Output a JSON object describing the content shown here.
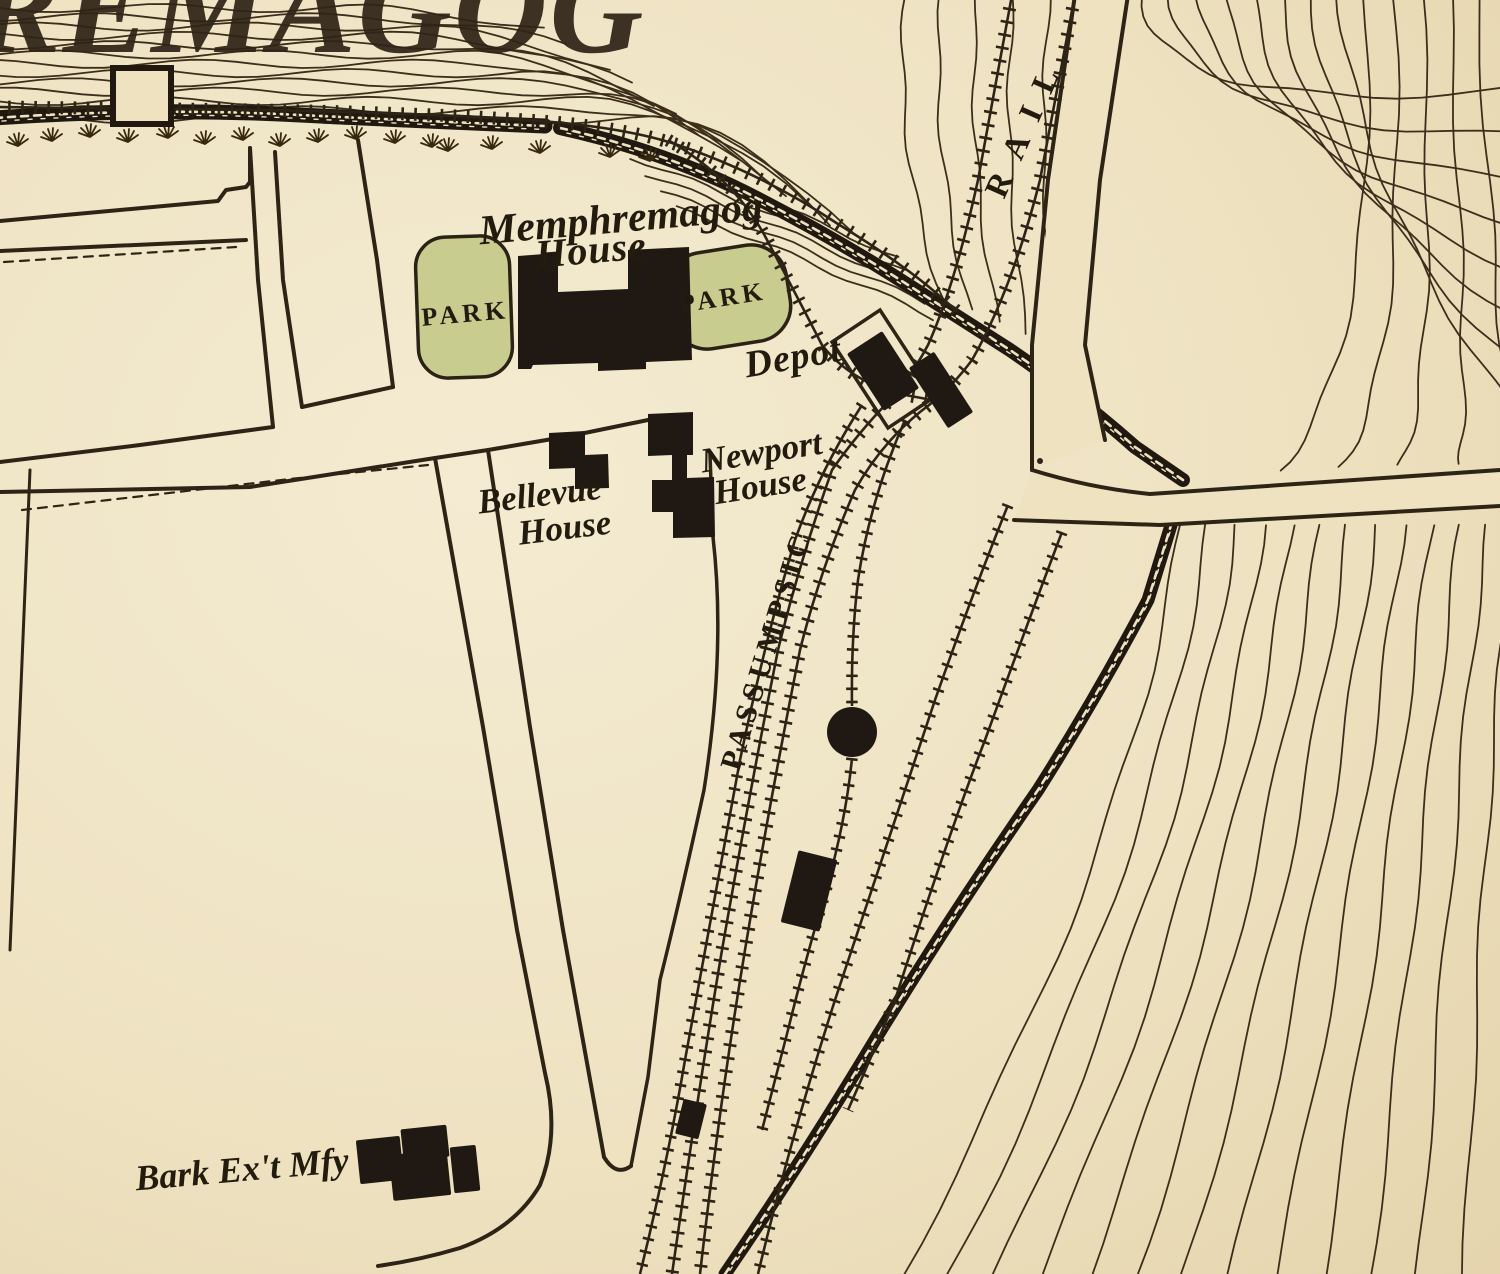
{
  "map": {
    "colors": {
      "paper": "#eee2c1",
      "paper_light": "#f4ebd2",
      "paper_edge": "#e4d3ab",
      "ink": "#2e2416",
      "contour": "#3c2e1b",
      "band": "#211910",
      "building": "#201812",
      "park_fill": "#c9cc8f",
      "park_stroke": "#2b2216",
      "label": "#231b0e",
      "grass": "#37290f"
    },
    "labels": [
      {
        "name": "lake-name-fragment",
        "text": "REMAGOG",
        "x": -26,
        "y": 52,
        "size": 130,
        "rotate": 0,
        "ls": 2,
        "style": "big",
        "anchor": "start"
      },
      {
        "name": "memphremagog-house-1",
        "text": "Memphremagog",
        "x": 622,
        "y": 232,
        "size": 42,
        "rotate": -5,
        "ls": 0,
        "style": "script",
        "anchor": "middle"
      },
      {
        "name": "memphremagog-house-2",
        "text": "House",
        "x": 592,
        "y": 263,
        "size": 40,
        "rotate": -5,
        "ls": 1,
        "style": "script",
        "anchor": "middle"
      },
      {
        "name": "depot-label",
        "text": "Depot",
        "x": 795,
        "y": 369,
        "size": 38,
        "rotate": -10,
        "ls": 1,
        "style": "script",
        "anchor": "middle"
      },
      {
        "name": "newport-house-1",
        "text": "Newport",
        "x": 763,
        "y": 463,
        "size": 35,
        "rotate": -9,
        "ls": 0,
        "style": "script",
        "anchor": "middle"
      },
      {
        "name": "newport-house-2",
        "text": "House",
        "x": 762,
        "y": 497,
        "size": 35,
        "rotate": -9,
        "ls": 0,
        "style": "script",
        "anchor": "middle"
      },
      {
        "name": "bellevue-house-1",
        "text": "Bellevue",
        "x": 541,
        "y": 506,
        "size": 35,
        "rotate": -7,
        "ls": 0,
        "style": "script",
        "anchor": "middle"
      },
      {
        "name": "bellevue-house-2",
        "text": "House",
        "x": 566,
        "y": 539,
        "size": 35,
        "rotate": -7,
        "ls": 0,
        "style": "script",
        "anchor": "middle"
      },
      {
        "name": "bark-extract-mfy",
        "text": "Bark Ex't Mfy",
        "x": 243,
        "y": 1181,
        "size": 36,
        "rotate": -5,
        "ls": 0,
        "style": "script",
        "anchor": "middle"
      },
      {
        "name": "park-label-left",
        "text": "PARK",
        "x": 466,
        "y": 322,
        "size": 26,
        "rotate": -5,
        "ls": 4,
        "style": "caps",
        "anchor": "middle"
      },
      {
        "name": "park-label-right",
        "text": "PARK",
        "x": 724,
        "y": 306,
        "size": 26,
        "rotate": -9,
        "ls": 4,
        "style": "caps",
        "anchor": "middle"
      },
      {
        "name": "passumpsic-railroad",
        "text": "PASSUMPSIC",
        "x": 739,
        "y": 772,
        "size": 30,
        "rotate": -73,
        "ls": 6,
        "style": "caps",
        "anchor": "start"
      },
      {
        "name": "rail-label",
        "text": "RAIL",
        "x": 1004,
        "y": 200,
        "size": 33,
        "rotate": -66,
        "ls": 18,
        "style": "caps",
        "anchor": "start"
      }
    ],
    "parks": [
      {
        "name": "park-west",
        "cx": 464,
        "cy": 307,
        "w": 94,
        "h": 141,
        "rx": 30,
        "rot": -2
      },
      {
        "name": "park-east",
        "cx": 729,
        "cy": 297,
        "w": 120,
        "h": 97,
        "rx": 36,
        "rot": -9
      }
    ],
    "buildings": [
      {
        "name": "memphremagog-house-building",
        "type": "path",
        "d": "M518,256 L558,253 L558,292 L628,289 L628,250 L689,247 L692,360 L646,362 L646,369 L598,371 L598,363 L533,365 L531,369 L518,369 Z"
      },
      {
        "name": "bellevue-house-building",
        "type": "path",
        "d": "M549,433 L585,431 L585,455 L608,454 L609,488 L575,489 L575,468 L549,469 Z"
      },
      {
        "name": "newport-house-building",
        "type": "path",
        "d": "M648,414 L693,412 L693,455 L687,455 L687,478 L714,477 L715,537 L673,538 L673,512 L652,512 L652,480 L672,480 L672,455 L648,456 Z"
      },
      {
        "name": "depot-building",
        "type": "rect",
        "cx": 883,
        "cy": 371,
        "w": 42,
        "h": 68,
        "rot": -33
      },
      {
        "name": "freight-building",
        "type": "rect",
        "cx": 941,
        "cy": 390,
        "w": 30,
        "h": 72,
        "rot": -33
      },
      {
        "name": "yard-building",
        "type": "rect",
        "cx": 809,
        "cy": 891,
        "w": 40,
        "h": 74,
        "rot": 14
      },
      {
        "name": "track-shed",
        "type": "rect",
        "cx": 691,
        "cy": 1119,
        "w": 24,
        "h": 36,
        "rot": 14
      },
      {
        "name": "bark-mill-a",
        "type": "rect",
        "cx": 380,
        "cy": 1160,
        "w": 44,
        "h": 44,
        "rot": -6
      },
      {
        "name": "bark-mill-b",
        "type": "rect",
        "cx": 425,
        "cy": 1143,
        "w": 46,
        "h": 32,
        "rot": -6
      },
      {
        "name": "bark-mill-c",
        "type": "rect",
        "cx": 420,
        "cy": 1175,
        "w": 58,
        "h": 46,
        "rot": -6
      },
      {
        "name": "bark-mill-d",
        "type": "rect",
        "cx": 465,
        "cy": 1169,
        "w": 26,
        "h": 46,
        "rot": -6
      }
    ],
    "turntable": {
      "cx": 852,
      "cy": 732,
      "r": 25
    },
    "outlines": [
      {
        "name": "depot-platform",
        "type": "polygon",
        "points": "936,396 880,310 832,342 888,428",
        "w": 3.5
      },
      {
        "name": "wharf",
        "type": "rect",
        "x": 113,
        "y": 68,
        "w": 58,
        "h": 56,
        "sw": 6
      }
    ],
    "road_fills": [
      {
        "name": "bridge-street-fill",
        "points": "1075,-5 1128,-5 1085,345 1105,440 1032,470 1032,345"
      },
      {
        "name": "shore-road-fill",
        "points": "1032,470 1150,494 1500,470 1500,506 1160,525 1014,520"
      }
    ],
    "lines": [
      {
        "name": "block-nw-south-edge",
        "d": "M0,221 L218,201 L226,190 L246,187 L250,182 L250,148",
        "w": 4
      },
      {
        "name": "cross-street-south",
        "d": "M0,251 L246,240",
        "w": 4
      },
      {
        "name": "block-nw-setback",
        "d": "M4,262 L236,247",
        "w": 2.2,
        "dash": "9 7"
      },
      {
        "name": "main-street-west",
        "d": "M250,148 L258,280 L273,427",
        "w": 4
      },
      {
        "name": "main-street-east",
        "d": "M275,152 L283,280 L302,407",
        "w": 4
      },
      {
        "name": "ne-block-east",
        "d": "M358,140 L377,260 L393,387",
        "w": 4
      },
      {
        "name": "ne-block-south",
        "d": "M302,407 L393,387",
        "w": 4
      },
      {
        "name": "sw-road-north",
        "d": "M0,462 L140,445 L273,427",
        "w": 4
      },
      {
        "name": "sw-road-south",
        "d": "M0,492 L250,487 L435,458",
        "w": 4
      },
      {
        "name": "sw-block-setback",
        "d": "M22,510 L290,479 L428,465",
        "w": 2.2,
        "dash": "9 7"
      },
      {
        "name": "sw-block-west",
        "d": "M30,470 L10,950",
        "w": 3
      },
      {
        "name": "sw-block-east-lane",
        "d": "M435,458 L483,727 L517,930 L545,1073 Q560,1135 540,1185 Q515,1228 460,1248 Q420,1260 378,1266",
        "w": 4
      },
      {
        "name": "station-street-east",
        "d": "M488,450 L530,727 L563,930 L604,1157",
        "w": 4
      },
      {
        "name": "station-street-end",
        "d": "M604,1157 Q616,1177 631,1166",
        "w": 4
      },
      {
        "name": "rail-corridor-west-lot",
        "d": "M710,455 L713,537 Q726,650 704,790 Q680,900 660,980 L648,1077 L631,1166",
        "w": 3.5
      },
      {
        "name": "bellevue-block-north",
        "d": "M435,458 L488,450 L570,436 L648,420",
        "w": 4
      },
      {
        "name": "bridge-street-west",
        "d": "M1075,-5 L1048,180 L1032,345 L1032,470",
        "w": 4
      },
      {
        "name": "bridge-street-east",
        "d": "M1128,-5 L1100,180 L1085,345 L1105,440",
        "w": 4
      },
      {
        "name": "shore-road-north",
        "d": "M1032,470 Q1090,488 1150,494 L1500,470",
        "w": 4
      },
      {
        "name": "shore-road-south",
        "d": "M1014,520 L1160,525 L1500,506",
        "w": 4
      }
    ],
    "bands": [
      {
        "name": "lake-shore-band",
        "d": "M-5,118 Q140,108 280,114 Q420,121 545,126",
        "w": 15
      },
      {
        "name": "outlet-shore-band",
        "d": "M560,128 Q660,150 745,192 Q830,235 905,283 Q960,318 1010,350 Q1080,398 1135,447 L1183,480",
        "w": 14
      },
      {
        "name": "river-bank-band",
        "d": "M1172,522 L1148,600 Q1095,700 1038,790 Q958,905 878,1035 Q800,1165 725,1274",
        "w": 13
      }
    ],
    "tracks": [
      {
        "name": "shore-track",
        "d": "M-5,107 L260,110 Q430,113 540,121 Q620,127 672,143 Q760,172 838,224 Q900,262 935,292 L958,312",
        "tick": 13
      },
      {
        "name": "loop-track",
        "d": "M668,140 Q734,178 766,238 Q800,302 822,345 Q850,381 900,394 L948,403",
        "tick": 13
      },
      {
        "name": "bridge-track-west",
        "d": "M1012,-5 L978,180 Q955,285 928,345 Q912,375 893,397 Q860,430 832,470 Q800,560 778,650 Q750,790 722,950 Q700,1080 672,1274",
        "tick": 13
      },
      {
        "name": "bridge-track-east",
        "d": "M1075,-5 L1040,180 Q1012,290 972,360 Q950,390 920,412 Q880,445 855,490 Q820,570 800,650 Q770,800 745,950 Q720,1100 700,1274",
        "tick": 13
      },
      {
        "name": "yard-track-west",
        "d": "M862,405 Q820,470 795,540 Q765,640 740,760 Q710,920 685,1060 Q668,1160 640,1274",
        "tick": 11.5
      },
      {
        "name": "turntable-spur",
        "d": "M905,420 Q870,500 858,580 Q851,640 852,706",
        "tick": 11.5
      },
      {
        "name": "turntable-spur-south",
        "d": "M852,758 Q846,820 826,890 Q804,965 788,1030 Q775,1080 762,1130",
        "tick": 11.5
      },
      {
        "name": "siding-east-1",
        "d": "M1008,505 Q970,600 935,700 Q885,850 835,1000 Q790,1140 758,1274",
        "tick": 11.5
      },
      {
        "name": "siding-east-2",
        "d": "M1062,532 Q1025,630 985,740 Q950,830 895,1000 Q870,1060 848,1110",
        "tick": 11.5
      }
    ],
    "contour_groups": [
      {
        "name": "lake-contours",
        "type": "lake",
        "n": 13
      },
      {
        "name": "bluff-contours-west",
        "type": "f1w",
        "n": 5
      },
      {
        "name": "bluff-contours-east",
        "type": "f1e",
        "n": 13
      },
      {
        "name": "river-slope-contours",
        "type": "f2b",
        "n": 14
      },
      {
        "name": "outlet-slope-contours",
        "type": "shoremid",
        "n": 5
      }
    ],
    "grass": [
      [
        18,
        146
      ],
      [
        52,
        141
      ],
      [
        90,
        137
      ],
      [
        128,
        142
      ],
      [
        168,
        138
      ],
      [
        205,
        144
      ],
      [
        243,
        140
      ],
      [
        280,
        146
      ],
      [
        318,
        142
      ],
      [
        356,
        139
      ],
      [
        395,
        143
      ],
      [
        432,
        147
      ],
      [
        448,
        151
      ],
      [
        492,
        149
      ],
      [
        540,
        153
      ],
      [
        610,
        157
      ],
      [
        650,
        161
      ]
    ],
    "dots": [
      [
        1040,
        461
      ]
    ]
  }
}
